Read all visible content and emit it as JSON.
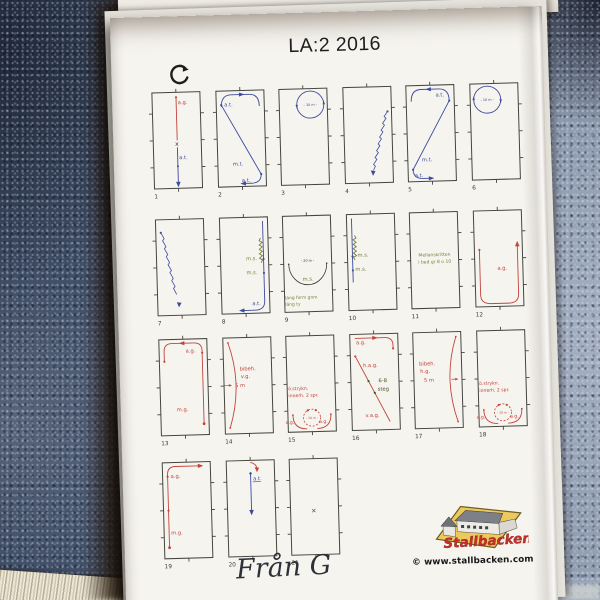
{
  "page": {
    "title": "LA:2 2016",
    "direction_mark": "G",
    "footer": {
      "website": "© www.stallbacken.com",
      "logo_name": "Stallbacken",
      "handwriting": "Från G"
    }
  },
  "colors": {
    "red": "#c2443c",
    "blue": "#3c4b9f",
    "green": "#77813a",
    "dgreen": "#41541f",
    "dark": "#3a3a3a"
  },
  "back_sheet": {
    "boxes": [
      {
        "x": 24,
        "w": 63,
        "deco": "redline",
        "label": ""
      },
      {
        "x": 99,
        "w": 24,
        "deco": "",
        "label": ""
      },
      {
        "x": 131,
        "w": 82,
        "deco": "arrowl",
        "label": "a.t."
      },
      {
        "x": 226,
        "w": 54,
        "deco": "curve",
        "label": "f"
      },
      {
        "x": 292,
        "w": 56,
        "deco": "",
        "label": ""
      },
      {
        "x": 358,
        "w": 56,
        "deco": "arrowr",
        "label": ""
      }
    ]
  },
  "movements": [
    {
      "n": "1",
      "f": "fig1",
      "labels": [
        {
          "t": "a.g.",
          "c": "red",
          "x": 30.5,
          "y": 16
        },
        {
          "t": "a.t.",
          "c": "blue",
          "x": 30.5,
          "y": 71
        },
        {
          "t": "x",
          "c": "dark",
          "x": 26.8,
          "y": 57.5,
          "s": 6.2
        }
      ]
    },
    {
      "n": "2",
      "f": "fig2",
      "labels": [
        {
          "t": "a.t.",
          "c": "blue",
          "x": 13,
          "y": 19.5
        },
        {
          "t": "m.t.",
          "c": "blue",
          "x": 20,
          "y": 79
        },
        {
          "t": "a.t.",
          "c": "blue",
          "x": 28.5,
          "y": 95.5
        }
      ]
    },
    {
      "n": "3",
      "f": "fig3",
      "labels": [
        {
          "t": "- 10 m -",
          "c": "blue",
          "x": 36,
          "y": 21.3,
          "s": 3.4,
          "a": "middle"
        }
      ]
    },
    {
      "n": "4",
      "f": "fig4",
      "labels": []
    },
    {
      "n": "5",
      "f": "fig5",
      "labels": [
        {
          "t": "a.t.",
          "c": "blue",
          "x": 34.5,
          "y": 15.5
        },
        {
          "t": "m.t.",
          "c": "blue",
          "x": 19,
          "y": 80
        },
        {
          "t": "a.t.",
          "c": "blue",
          "x": 11.5,
          "y": 95.5
        }
      ]
    },
    {
      "n": "6",
      "f": "fig6",
      "labels": [
        {
          "t": "- 10 m -",
          "c": "blue",
          "x": 22,
          "y": 21.3,
          "s": 3.4,
          "a": "middle"
        }
      ]
    },
    {
      "n": "7",
      "f": "fig7",
      "labels": []
    },
    {
      "n": "8",
      "f": "fig8",
      "labels": [
        {
          "t": "m.s.",
          "c": "green",
          "x": 30.5,
          "y": 47
        },
        {
          "t": "m.s.",
          "c": "green",
          "x": 30.5,
          "y": 61
        },
        {
          "t": "a.t.",
          "c": "blue",
          "x": 35.5,
          "y": 92
        }
      ]
    },
    {
      "n": "9",
      "f": "fig9",
      "labels": [
        {
          "t": "- 20 m -",
          "c": "dark",
          "x": 29,
          "y": 50,
          "s": 3.4,
          "a": "middle"
        },
        {
          "t": "m.s.",
          "c": "green",
          "x": 23.5,
          "y": 69
        },
        {
          "t": "läng form gnm",
          "c": "green",
          "x": 5.5,
          "y": 87,
          "s": 4.4
        },
        {
          "t": "läng ty",
          "c": "green",
          "x": 5.5,
          "y": 93.5,
          "s": 4.4
        }
      ]
    },
    {
      "n": "10",
      "f": "fig10",
      "labels": [
        {
          "t": "m.s.",
          "c": "green",
          "x": 15,
          "y": 46.5
        },
        {
          "t": "m.s.",
          "c": "green",
          "x": 12.5,
          "y": 60.5
        }
      ]
    },
    {
      "n": "11",
      "f": "fig11",
      "labels": [
        {
          "t": "Mellanskritten",
          "c": "green",
          "x": 29,
          "y": 48,
          "s": 4.5,
          "a": "middle"
        },
        {
          "t": "i bed gr 8 o 10",
          "c": "green",
          "x": 29,
          "y": 55,
          "s": 4.5,
          "a": "middle"
        }
      ]
    },
    {
      "n": "12",
      "f": "fig12",
      "labels": [
        {
          "t": "a.g.",
          "c": "red",
          "x": 27.5,
          "y": 63.5
        }
      ]
    },
    {
      "n": "13",
      "f": "fig13",
      "labels": [
        {
          "t": "a.g.",
          "c": "red",
          "x": 31.5,
          "y": 17.5
        },
        {
          "t": "m.g.",
          "c": "red",
          "x": 21,
          "y": 76
        }
      ]
    },
    {
      "n": "14",
      "f": "fig14",
      "labels": [
        {
          "t": "bibeh.",
          "c": "red",
          "x": 21,
          "y": 37
        },
        {
          "t": "v.g.",
          "c": "red",
          "x": 22,
          "y": 44.5
        },
        {
          "t": "5 m",
          "c": "red",
          "x": 16,
          "y": 53.5
        }
      ]
    },
    {
      "n": "15",
      "f": "fig15",
      "labels": [
        {
          "t": "ö.strykn.",
          "c": "red",
          "x": 6,
          "y": 58,
          "s": 4.6
        },
        {
          "t": "innerh. 2 spr.",
          "c": "red",
          "x": 6,
          "y": 65,
          "s": 4.6
        },
        {
          "t": "a.g.",
          "c": "red",
          "x": 2.5,
          "y": 91.5,
          "s": 4.6
        },
        {
          "t": "a.g.",
          "c": "red",
          "x": 36,
          "y": 91.5,
          "s": 4.6
        },
        {
          "t": "- 10 m -",
          "c": "red",
          "x": 29,
          "y": 87.3,
          "s": 3,
          "a": "middle"
        }
      ]
    },
    {
      "n": "16",
      "f": "fig16",
      "labels": [
        {
          "t": "a.g.",
          "c": "red",
          "x": 11,
          "y": 14
        },
        {
          "t": "h.a.g.",
          "c": "red",
          "x": 17.5,
          "y": 37
        },
        {
          "t": "6-8",
          "c": "dgreen",
          "x": 32.5,
          "y": 52.5
        },
        {
          "t": "steg",
          "c": "dgreen",
          "x": 31.5,
          "y": 61
        },
        {
          "t": "v.a.g.",
          "c": "red",
          "x": 18.5,
          "y": 87
        }
      ]
    },
    {
      "n": "17",
      "f": "fig17",
      "labels": [
        {
          "t": "bibeh.",
          "c": "red",
          "x": 10.5,
          "y": 37
        },
        {
          "t": "h.g.",
          "c": "red",
          "x": 11.5,
          "y": 44.5
        },
        {
          "t": "5 m",
          "c": "red",
          "x": 15,
          "y": 53.5
        }
      ]
    },
    {
      "n": "18",
      "f": "fig18",
      "labels": [
        {
          "t": "ö.strykn.",
          "c": "red",
          "x": 6,
          "y": 58,
          "s": 4.6
        },
        {
          "t": "innerh. 2 spr.",
          "c": "red",
          "x": 6,
          "y": 65,
          "s": 4.6
        },
        {
          "t": "a.g.",
          "c": "red",
          "x": 2.5,
          "y": 91.5,
          "s": 4.6
        },
        {
          "t": "a.g.",
          "c": "red",
          "x": 36,
          "y": 91.5,
          "s": 4.6
        },
        {
          "t": "- 10 m -",
          "c": "red",
          "x": 29,
          "y": 87.3,
          "s": 3,
          "a": "middle"
        }
      ]
    },
    {
      "n": "19",
      "f": "fig19",
      "labels": [
        {
          "t": "a.g.",
          "c": "red",
          "x": 13,
          "y": 19.5
        },
        {
          "t": "m.g.",
          "c": "red",
          "x": 12,
          "y": 76
        }
      ]
    },
    {
      "n": "20",
      "f": "fig20",
      "labels": [
        {
          "t": "a.t.",
          "c": "blue",
          "x": 31.5,
          "y": 24
        }
      ]
    },
    {
      "n": "21",
      "f": "fig21",
      "labels": [
        {
          "t": "×",
          "c": "dark",
          "x": 25.5,
          "y": 58,
          "s": 6.5
        }
      ]
    }
  ]
}
